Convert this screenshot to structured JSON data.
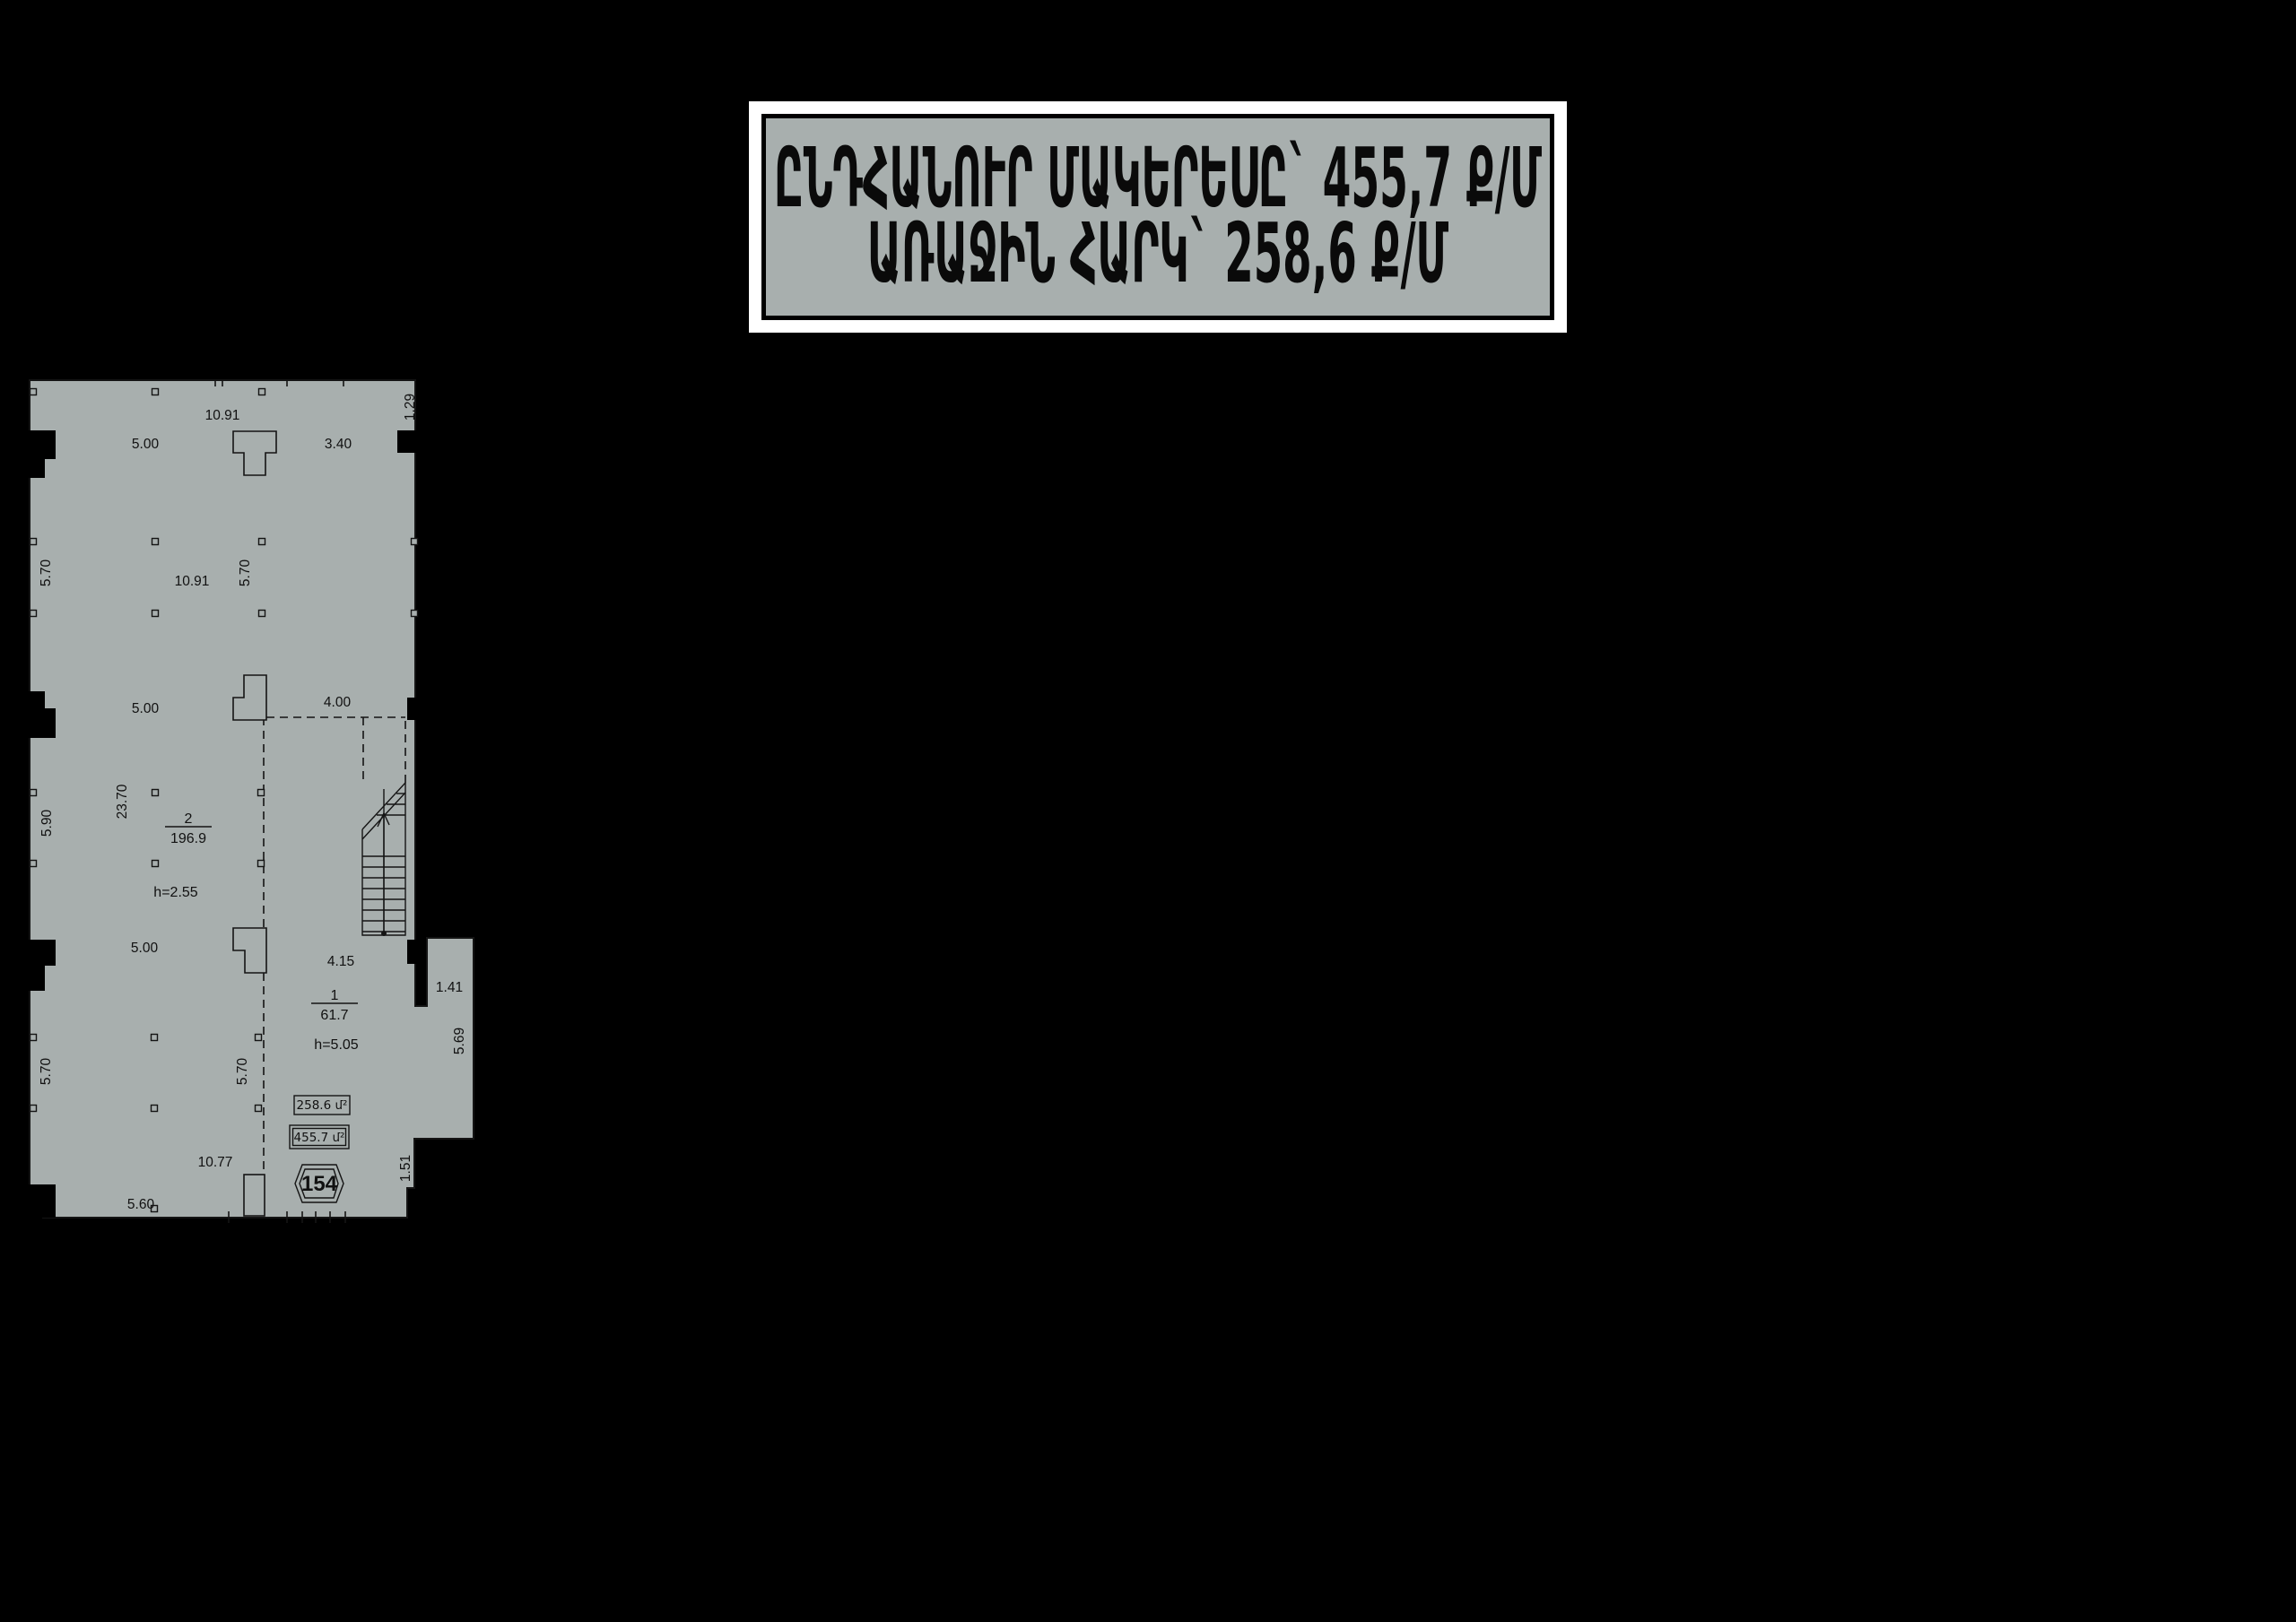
{
  "page": {
    "background": "#000000"
  },
  "title_box": {
    "line1": "ԸՆԴՀԱՆՈՒՐ ՄԱԿԵՐԵՍԸ` 455,7 Ք/Մ",
    "line2": "ԱՌԱՋԻՆ ՀԱՐԿ` 258,6 Ք/Մ",
    "frame_color": "#ffffff",
    "border_color": "#000000",
    "fill": "#a8afae",
    "text_color": "#0a0a0a"
  },
  "plan": {
    "fill": "#a8afae",
    "line_color": "#141414",
    "unit_number": "154",
    "area_boxes": {
      "first_floor": "258.6 մ²",
      "total": "455.7 մ²"
    },
    "rooms": [
      {
        "number": "2",
        "area": "196.9",
        "ceiling_height": "h=2.55"
      },
      {
        "number": "1",
        "area": "61.7",
        "ceiling_height": "h=5.05"
      }
    ],
    "dims": [
      {
        "value": "10.91",
        "loc": "top-span"
      },
      {
        "value": "5.00",
        "loc": "top-left-bay"
      },
      {
        "value": "3.40",
        "loc": "top-right-bay"
      },
      {
        "value": "1.29",
        "loc": "right-edge-top"
      },
      {
        "value": "5.70",
        "loc": "left-upper-bay"
      },
      {
        "value": "10.91",
        "loc": "upper-middle-span"
      },
      {
        "value": "5.70",
        "loc": "upper-middle-bay"
      },
      {
        "value": "5.00",
        "loc": "left-mid-bay"
      },
      {
        "value": "4.00",
        "loc": "mezzanine-width"
      },
      {
        "value": "23.70",
        "loc": "left-long-span"
      },
      {
        "value": "5.90",
        "loc": "left-middle-bay"
      },
      {
        "value": "5.00",
        "loc": "left-lower-bay"
      },
      {
        "value": "4.15",
        "loc": "room1-width"
      },
      {
        "value": "1.41",
        "loc": "annex-top-width"
      },
      {
        "value": "5.69",
        "loc": "annex-right-depth"
      },
      {
        "value": "5.70",
        "loc": "left-bottom-bay"
      },
      {
        "value": "5.70",
        "loc": "middle-bottom-bay"
      },
      {
        "value": "10.77",
        "loc": "bottom-span"
      },
      {
        "value": "1.51",
        "loc": "right-bottom-edge"
      },
      {
        "value": "5.60",
        "loc": "bottom-left-bay"
      }
    ]
  }
}
